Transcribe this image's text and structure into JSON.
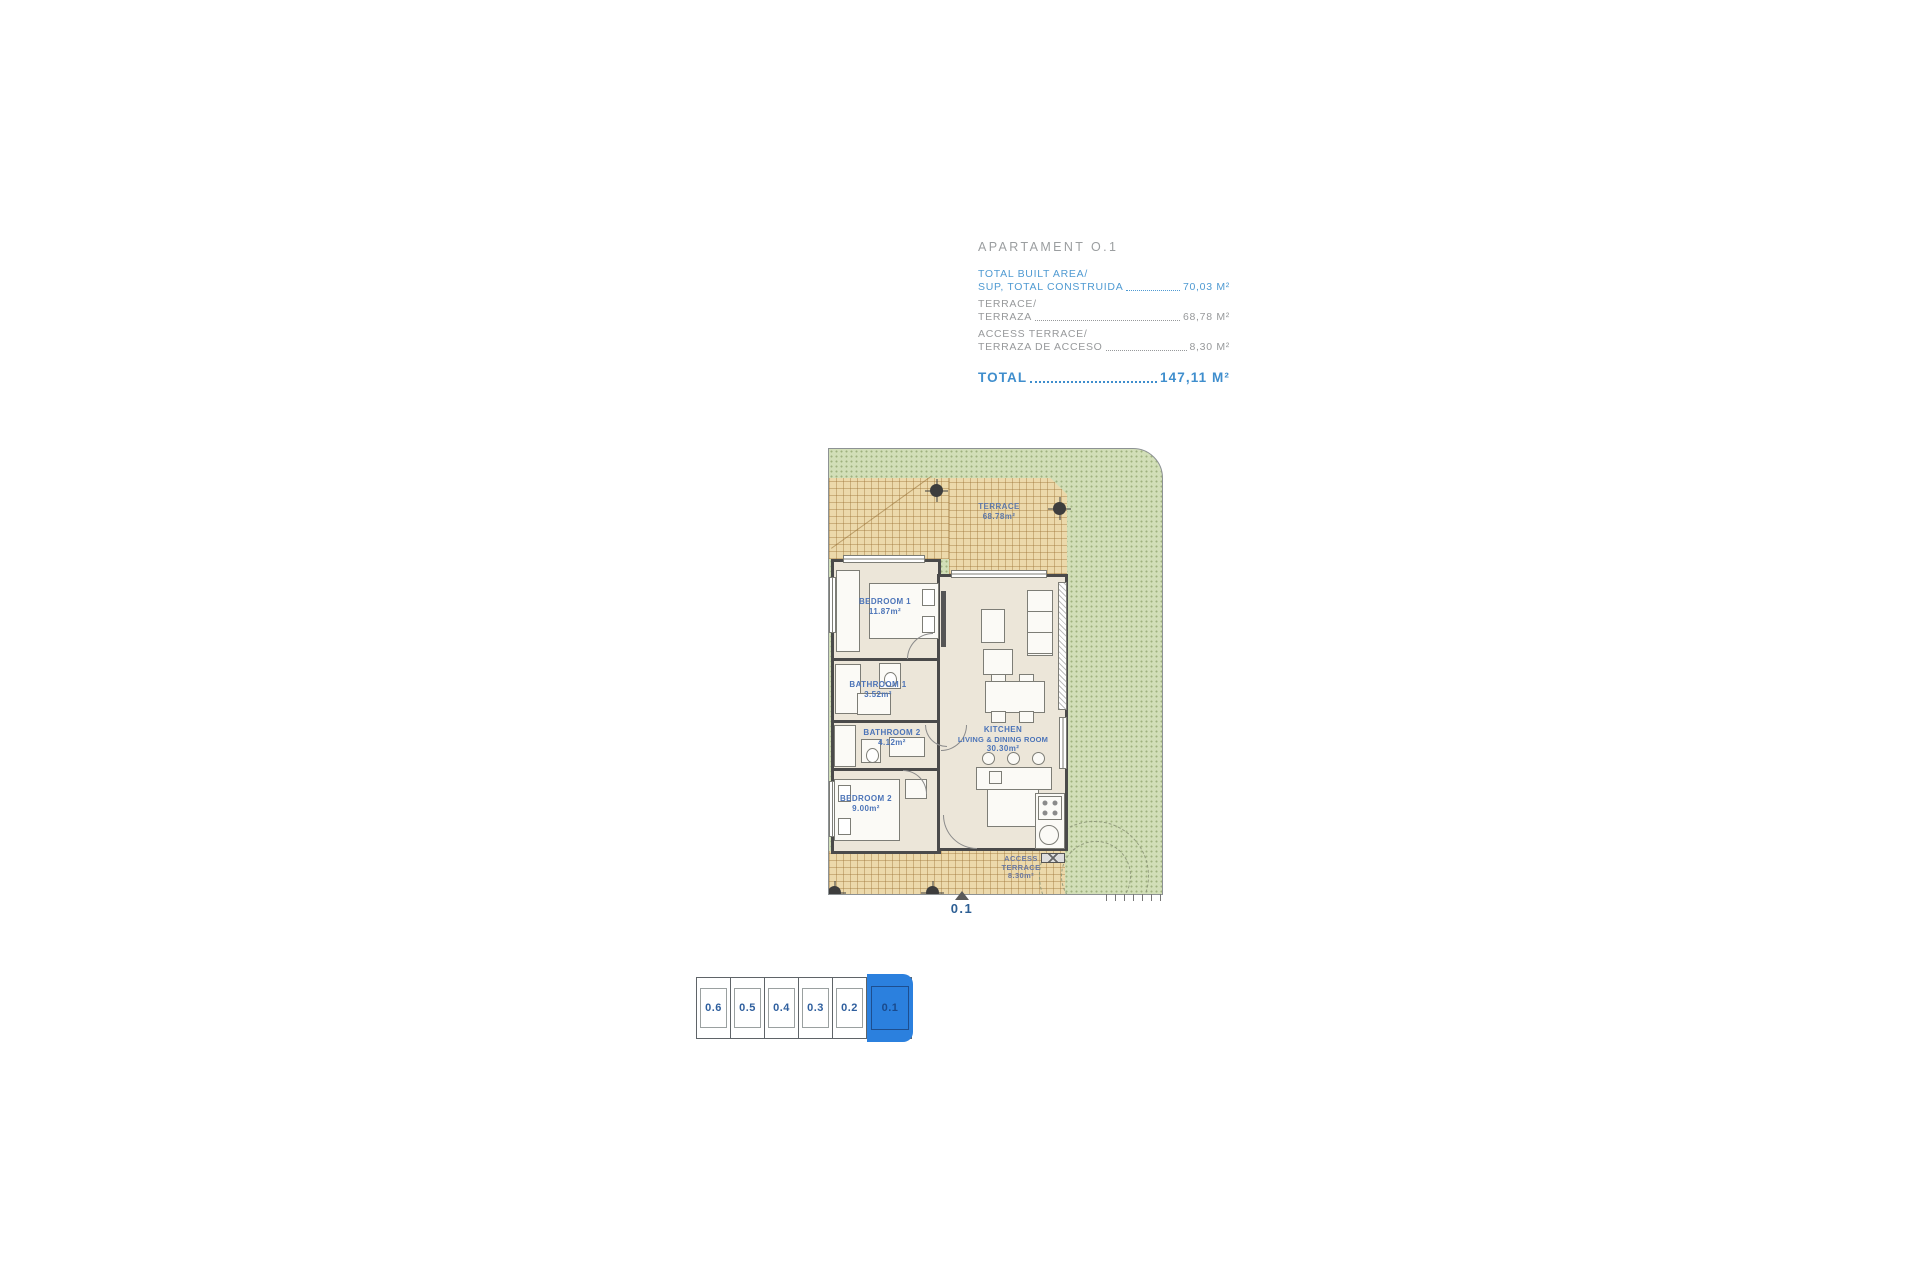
{
  "title_block": {
    "title": "APARTAMENT O.1",
    "rows": [
      {
        "line1": "TOTAL BUILT AREA/",
        "line2": "SUP, TOTAL CONSTRUIDA",
        "value": "70,03 M²"
      },
      {
        "line1": "TERRACE/",
        "line2": "TERRAZA",
        "value": "68,78 M²"
      },
      {
        "line1": "ACCESS TERRACE/",
        "line2": "TERRAZA DE ACCESO",
        "value": "8,30 M²"
      }
    ],
    "total_label": "TOTAL",
    "total_value": "147,11 M²"
  },
  "plan": {
    "unit_marker": "0.1",
    "rooms": {
      "terrace": {
        "name": "TERRACE",
        "area": "68.78m²"
      },
      "bedroom1": {
        "name": "BEDROOM 1",
        "area": "11.87m²"
      },
      "bathroom1": {
        "name": "BATHROOM 1",
        "area": "3.52m²"
      },
      "bathroom2": {
        "name": "BATHROOM 2",
        "area": "4.12m²"
      },
      "bedroom2": {
        "name": "BEDROOM 2",
        "area": "9.00m²"
      },
      "kitchen": {
        "line1": "KITCHEN",
        "line2": "LIVING & DINING ROOM",
        "area": "30.30m²"
      },
      "access_terrace": {
        "line1": "ACCESS",
        "line2": "TERRACE",
        "area": "8.30m²"
      }
    }
  },
  "minimap": {
    "cells": [
      {
        "label": "0.6",
        "active": false
      },
      {
        "label": "0.5",
        "active": false
      },
      {
        "label": "0.4",
        "active": false
      },
      {
        "label": "0.3",
        "active": false
      },
      {
        "label": "0.2",
        "active": false
      },
      {
        "label": "0.1",
        "active": true
      }
    ]
  },
  "colors": {
    "accent_blue": "#4f9ad2",
    "total_blue": "#3f8ecd",
    "room_label_blue": "#4c74b8",
    "muted_gray": "#97999b",
    "terrace_tan": "#ecd9ab",
    "lawn_green": "#d2dfb8",
    "floor_cream": "#ece6d9",
    "wall_gray": "#4a4a4a",
    "highlight_blue": "#2b80de"
  }
}
